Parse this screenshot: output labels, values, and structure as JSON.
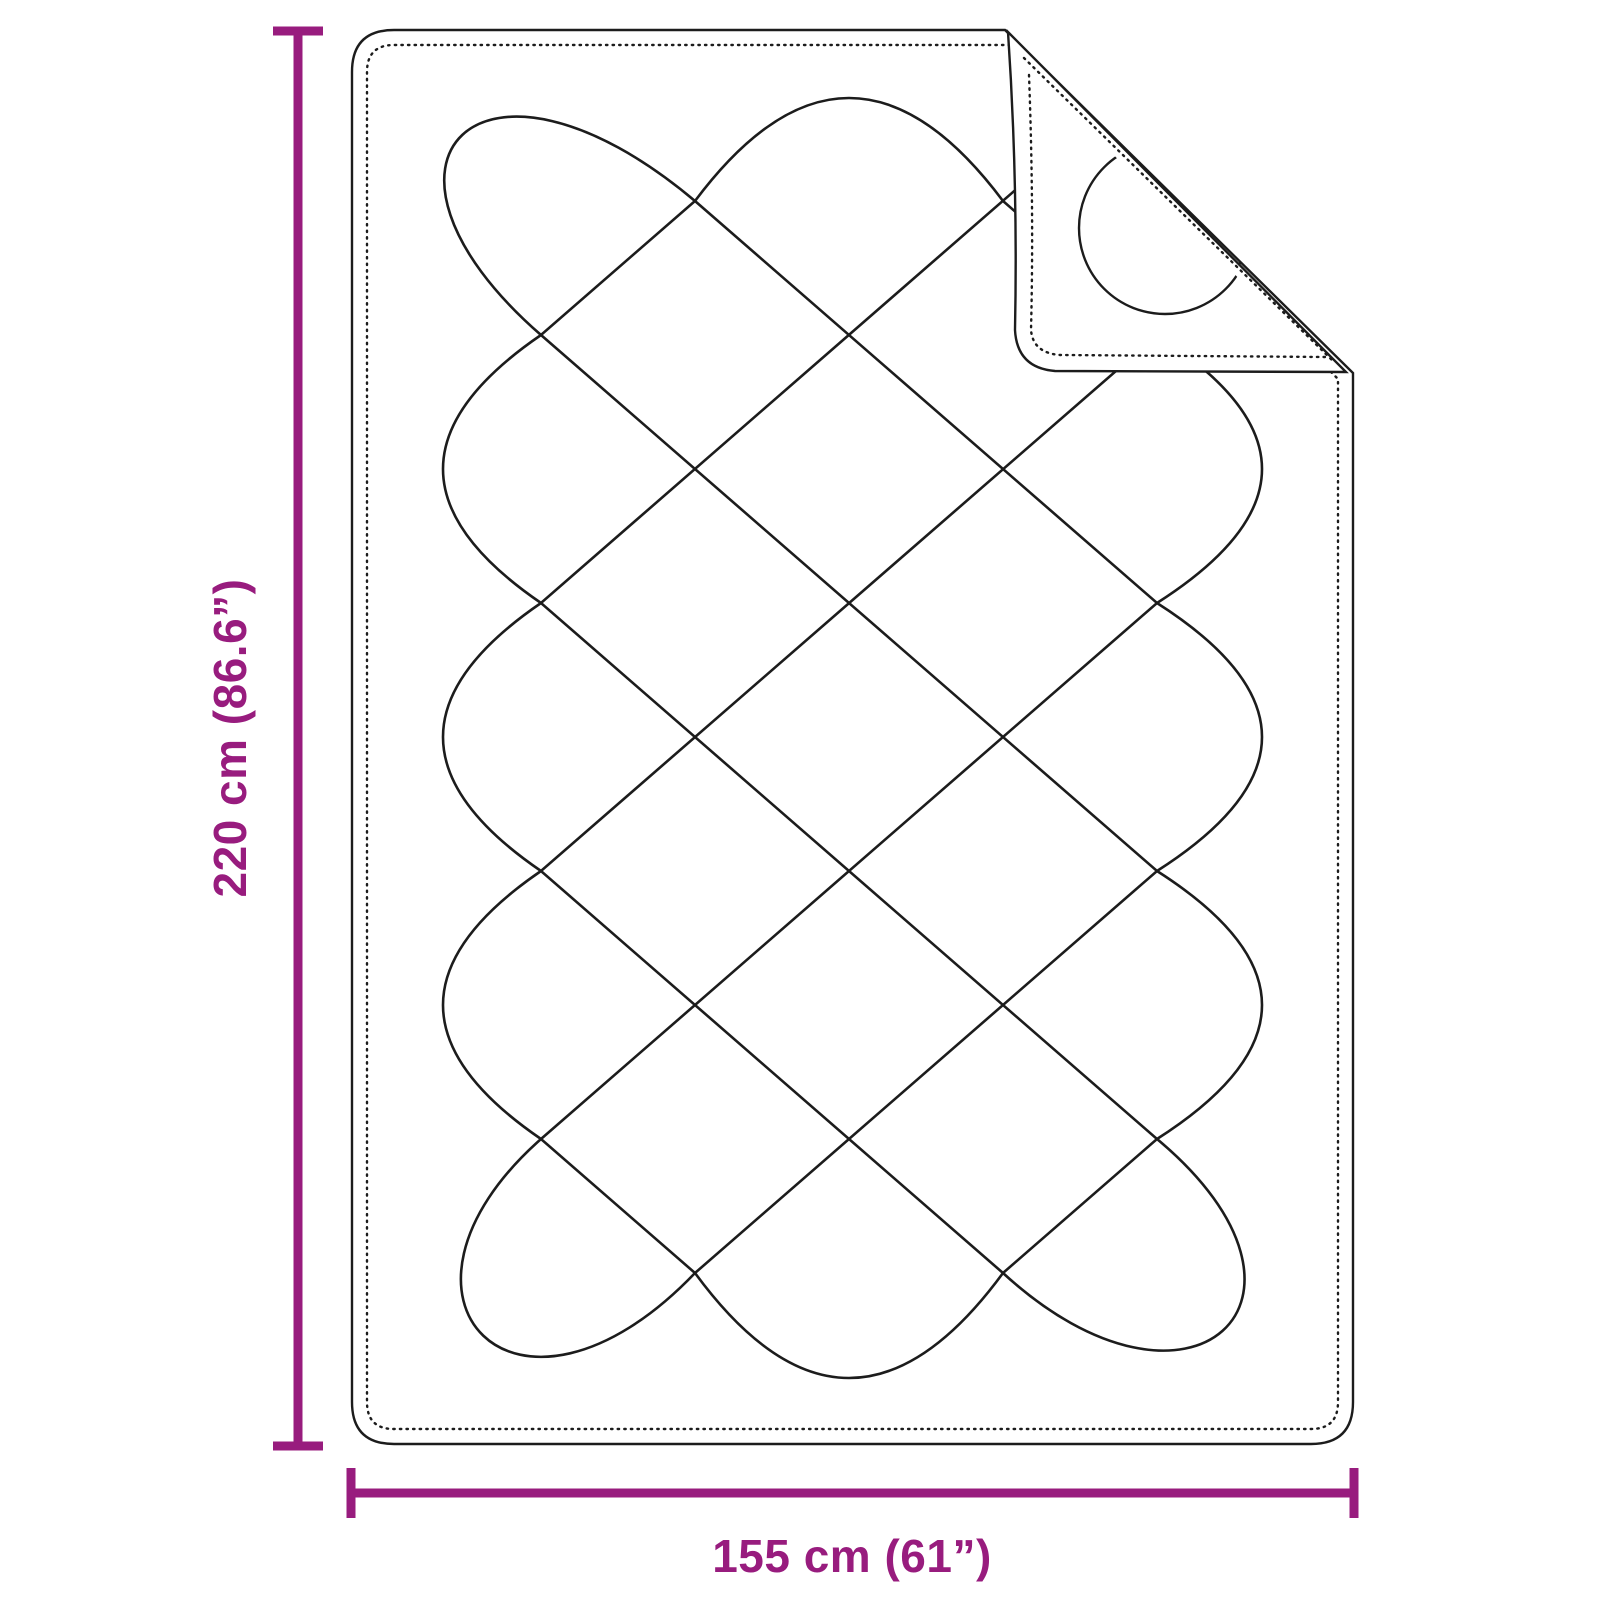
{
  "diagram": {
    "title": "quilted-blanket-dimension-diagram",
    "product": "quilted blanket with folded corner",
    "accent_color": "#981c7e",
    "line_color": "#1c1c1c",
    "background_color": "#ffffff",
    "dimensions": {
      "height": {
        "label": "220 cm (86.6”)",
        "value_cm": 220,
        "value_inch": 86.6
      },
      "width": {
        "label": "155 cm (61”)",
        "value_cm": 155,
        "value_inch": 61
      }
    }
  }
}
